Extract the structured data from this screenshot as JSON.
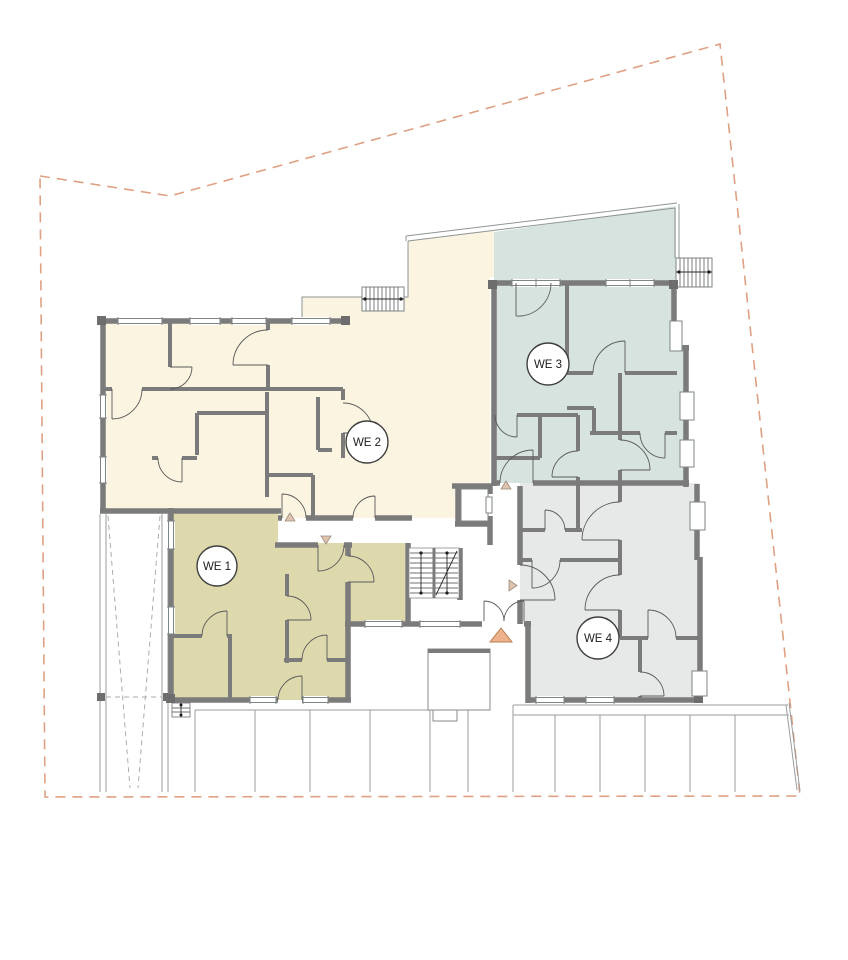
{
  "plan": {
    "units": [
      {
        "id": "we1",
        "label": "WE 1",
        "color": "#ded8ad"
      },
      {
        "id": "we2",
        "label": "WE 2",
        "color": "#faf4e0"
      },
      {
        "id": "we3",
        "label": "WE 3",
        "color": "#d7e3de"
      },
      {
        "id": "we4",
        "label": "WE 4",
        "color": "#e7e9e8"
      }
    ],
    "colors": {
      "wall": "#7b7b7b",
      "thin_line": "#9a9e9e",
      "boundary": "#dfa083",
      "entrance_marker": "#edb28b",
      "unit_marker": "#dec3ae",
      "background": "#ffffff"
    }
  }
}
